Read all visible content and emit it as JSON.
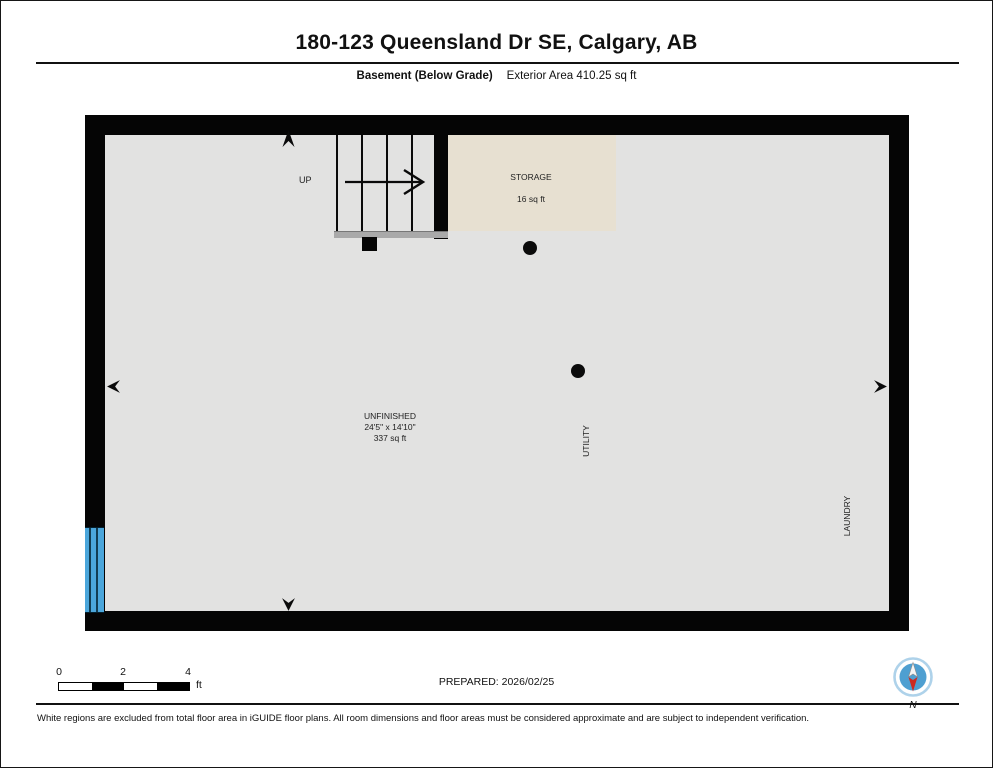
{
  "header": {
    "title": "180-123 Queensland Dr SE, Calgary, AB",
    "floor_label": "Basement (Below Grade)",
    "area_label": "Exterior Area 410.25 sq ft"
  },
  "plan": {
    "stairs": {
      "direction_label": "UP"
    },
    "rooms": {
      "storage": {
        "name": "STORAGE",
        "area": "16 sq ft"
      },
      "unfinished": {
        "name": "UNFINISHED",
        "dimensions": "24'5\" x 14'10\"",
        "area": "337 sq ft"
      },
      "utility": {
        "name": "UTILITY"
      },
      "laundry": {
        "name": "LAUNDRY"
      }
    }
  },
  "scale_bar": {
    "ticks": [
      "0",
      "2",
      "4"
    ],
    "unit": "ft"
  },
  "prepared": "PREPARED: 2026/02/25",
  "compass": {
    "label": "N"
  },
  "footer": {
    "disclaimer": "White regions are excluded from total floor area in iGUIDE floor plans. All room dimensions and floor areas must be considered approximate and are subject to independent verification."
  },
  "colors": {
    "wall": "#050505",
    "floor": "#e2e2e1",
    "storage_room": "#e7e0d1",
    "window_blue": "#4ba6db",
    "compass_blue": "#4e9fd1",
    "compass_red": "#cc2a20"
  }
}
